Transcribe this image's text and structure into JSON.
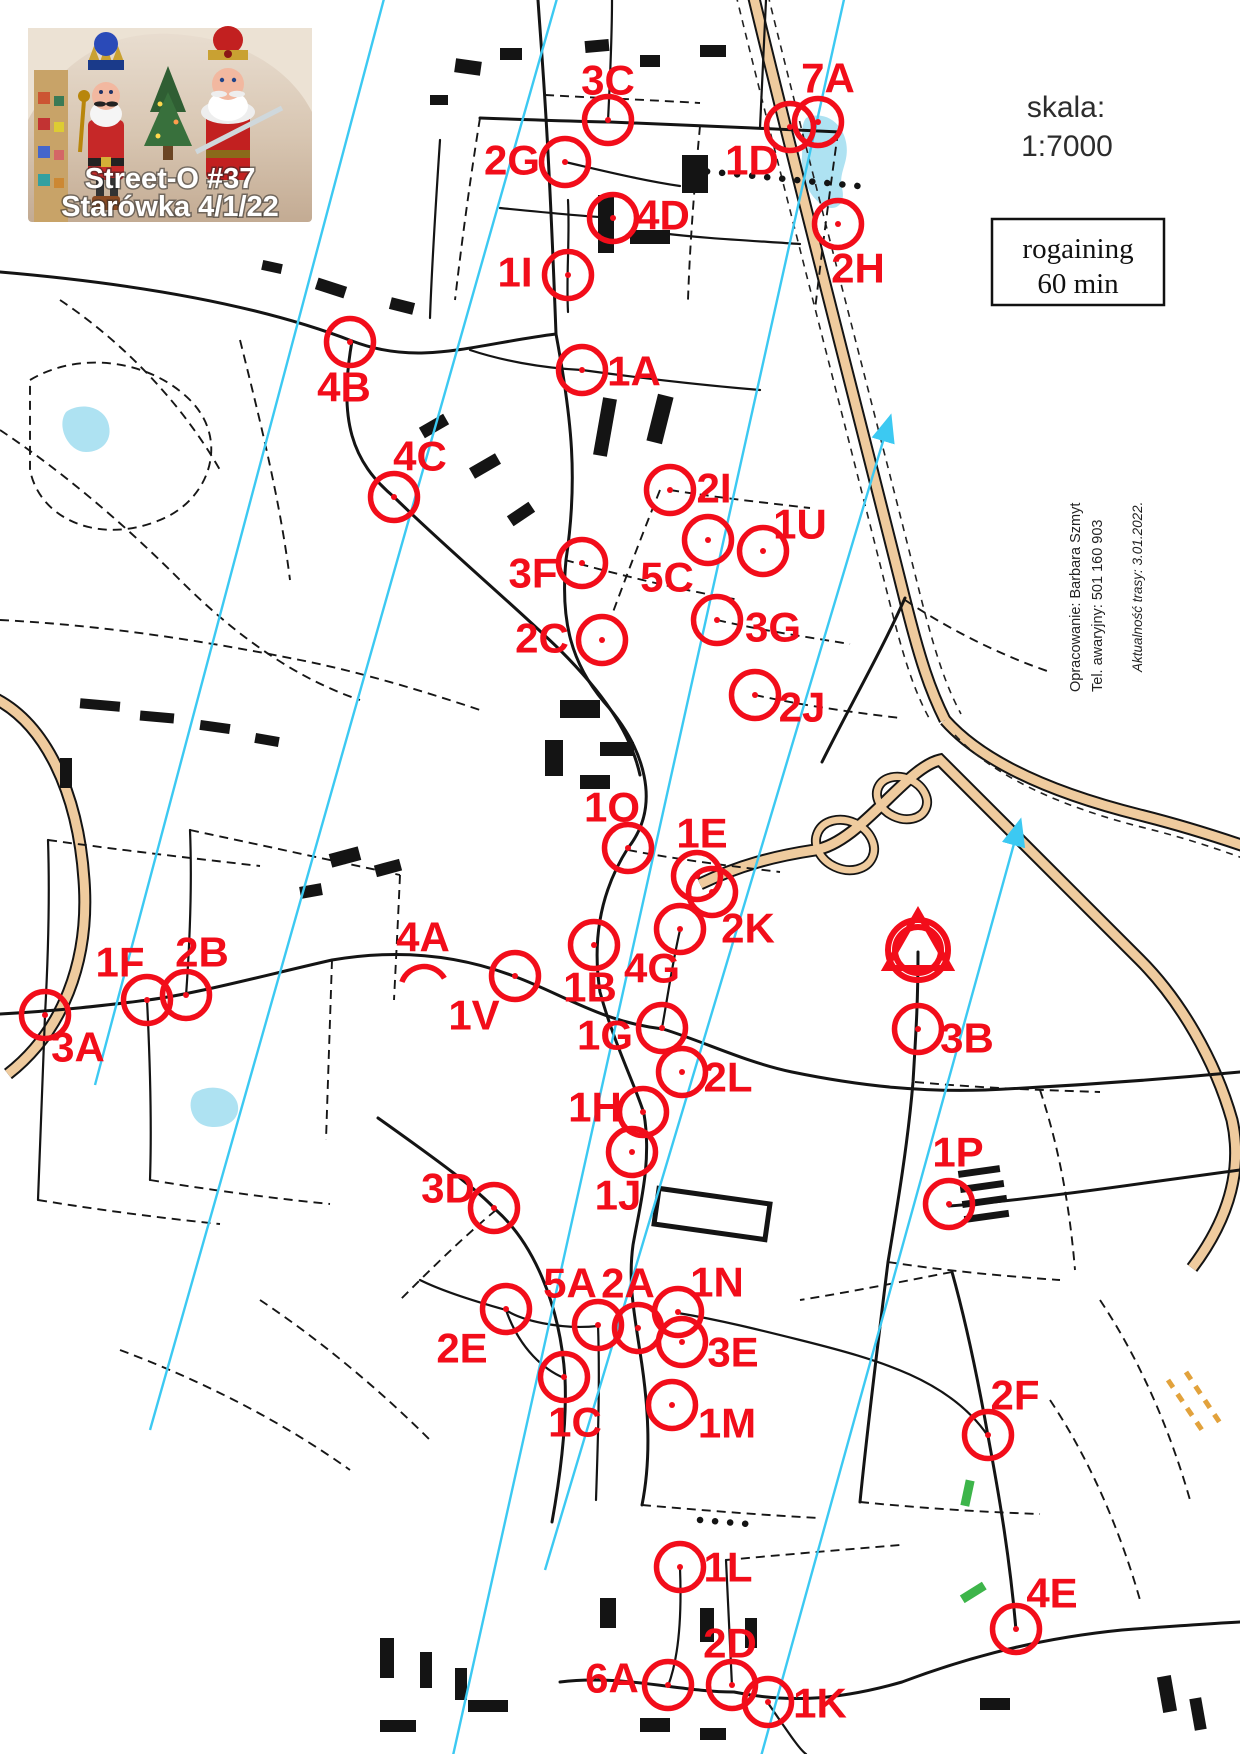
{
  "photo": {
    "line1": "Street-O #37",
    "line2": "Starówka 4/1/22"
  },
  "header": {
    "scale_label": "skala:",
    "scale_value": "1:7000",
    "format_line1": "rogaining",
    "format_line2": "60 min"
  },
  "credits": {
    "line1": "Opracowanie: Barbara Szmyt",
    "line2": "Tel. awaryjny: 501 160 903",
    "line3": "Aktualność trasy: 3.01.2022."
  },
  "colors": {
    "control": "#f20d1a",
    "north_line": "#3cc9f2",
    "road_fill": "#efcb9e",
    "water": "#aee2f2"
  },
  "start_finish": {
    "cx": 918,
    "cy": 950,
    "r_outer": 30,
    "r_inner": 23,
    "triangle_points": "918,912 886,968 950,968"
  },
  "controls": [
    {
      "id": "3C",
      "label_x": 608,
      "label_y": 80,
      "cx": 608,
      "cy": 120
    },
    {
      "id": "2G",
      "label_x": 512,
      "label_y": 160,
      "cx": 565,
      "cy": 162
    },
    {
      "id": "7A",
      "label_x": 828,
      "label_y": 78,
      "cx": 818,
      "cy": 122
    },
    {
      "id": "1D",
      "label_x": 752,
      "label_y": 160,
      "cx": 790,
      "cy": 127
    },
    {
      "id": "4D",
      "label_x": 663,
      "label_y": 215,
      "cx": 613,
      "cy": 218
    },
    {
      "id": "1I",
      "label_x": 515,
      "label_y": 272,
      "cx": 568,
      "cy": 275
    },
    {
      "id": "2H",
      "label_x": 858,
      "label_y": 268,
      "cx": 838,
      "cy": 224
    },
    {
      "id": "4B",
      "label_x": 344,
      "label_y": 387,
      "cx": 350,
      "cy": 342
    },
    {
      "id": "1A",
      "label_x": 634,
      "label_y": 371,
      "cx": 582,
      "cy": 370
    },
    {
      "id": "4C",
      "label_x": 420,
      "label_y": 456,
      "cx": 394,
      "cy": 497
    },
    {
      "id": "2I",
      "label_x": 714,
      "label_y": 488,
      "cx": 670,
      "cy": 490
    },
    {
      "id": "1U",
      "label_x": 800,
      "label_y": 524,
      "cx": 763,
      "cy": 551
    },
    {
      "id": "3F",
      "label_x": 533,
      "label_y": 573,
      "cx": 582,
      "cy": 563
    },
    {
      "id": "5C",
      "label_x": 667,
      "label_y": 577,
      "cx": 708,
      "cy": 540
    },
    {
      "id": "2C",
      "label_x": 542,
      "label_y": 638,
      "cx": 602,
      "cy": 640
    },
    {
      "id": "3G",
      "label_x": 773,
      "label_y": 627,
      "cx": 717,
      "cy": 620
    },
    {
      "id": "2J",
      "label_x": 802,
      "label_y": 707,
      "cx": 755,
      "cy": 695
    },
    {
      "id": "1O",
      "label_x": 612,
      "label_y": 807,
      "cx": 628,
      "cy": 848
    },
    {
      "id": "1E",
      "label_x": 702,
      "label_y": 833,
      "cx": 697,
      "cy": 876
    },
    {
      "id": "2K",
      "label_x": 748,
      "label_y": 928,
      "cx": 712,
      "cy": 892
    },
    {
      "id": "4G",
      "label_x": 652,
      "label_y": 968,
      "cx": 680,
      "cy": 929
    },
    {
      "id": "1B",
      "label_x": 590,
      "label_y": 987,
      "cx": 594,
      "cy": 945
    },
    {
      "id": "1V",
      "label_x": 474,
      "label_y": 1015,
      "cx": 515,
      "cy": 976
    },
    {
      "id": "4A",
      "label_x": 423,
      "label_y": 937,
      "cx": 424,
      "cy": 990,
      "arc": true
    },
    {
      "id": "2B",
      "label_x": 202,
      "label_y": 952,
      "cx": 186,
      "cy": 995
    },
    {
      "id": "1F",
      "label_x": 120,
      "label_y": 962,
      "cx": 147,
      "cy": 1000
    },
    {
      "id": "3A",
      "label_x": 78,
      "label_y": 1047,
      "cx": 45,
      "cy": 1015
    },
    {
      "id": "1G",
      "label_x": 605,
      "label_y": 1035,
      "cx": 662,
      "cy": 1028
    },
    {
      "id": "2L",
      "label_x": 728,
      "label_y": 1077,
      "cx": 682,
      "cy": 1072
    },
    {
      "id": "1H",
      "label_x": 595,
      "label_y": 1107,
      "cx": 643,
      "cy": 1112
    },
    {
      "id": "1J",
      "label_x": 618,
      "label_y": 1195,
      "cx": 632,
      "cy": 1152
    },
    {
      "id": "3B",
      "label_x": 967,
      "label_y": 1038,
      "cx": 918,
      "cy": 1029
    },
    {
      "id": "1P",
      "label_x": 958,
      "label_y": 1152,
      "cx": 949,
      "cy": 1204
    },
    {
      "id": "3D",
      "label_x": 448,
      "label_y": 1188,
      "cx": 494,
      "cy": 1208
    },
    {
      "id": "2E",
      "label_x": 462,
      "label_y": 1348,
      "cx": 506,
      "cy": 1309
    },
    {
      "id": "5A",
      "label_x": 570,
      "label_y": 1283,
      "cx": 598,
      "cy": 1325
    },
    {
      "id": "2A",
      "label_x": 628,
      "label_y": 1283,
      "cx": 638,
      "cy": 1328
    },
    {
      "id": "1N",
      "label_x": 717,
      "label_y": 1282,
      "cx": 678,
      "cy": 1312
    },
    {
      "id": "3E",
      "label_x": 733,
      "label_y": 1352,
      "cx": 682,
      "cy": 1342
    },
    {
      "id": "1C",
      "label_x": 575,
      "label_y": 1422,
      "cx": 564,
      "cy": 1377
    },
    {
      "id": "1M",
      "label_x": 727,
      "label_y": 1423,
      "cx": 672,
      "cy": 1405
    },
    {
      "id": "2F",
      "label_x": 1015,
      "label_y": 1395,
      "cx": 988,
      "cy": 1435
    },
    {
      "id": "1L",
      "label_x": 728,
      "label_y": 1567,
      "cx": 680,
      "cy": 1567
    },
    {
      "id": "4E",
      "label_x": 1052,
      "label_y": 1593,
      "cx": 1016,
      "cy": 1629
    },
    {
      "id": "2D",
      "label_x": 730,
      "label_y": 1643,
      "cx": 732,
      "cy": 1685
    },
    {
      "id": "6A",
      "label_x": 612,
      "label_y": 1678,
      "cx": 668,
      "cy": 1685
    },
    {
      "id": "1K",
      "label_x": 820,
      "label_y": 1703,
      "cx": 768,
      "cy": 1702
    }
  ]
}
